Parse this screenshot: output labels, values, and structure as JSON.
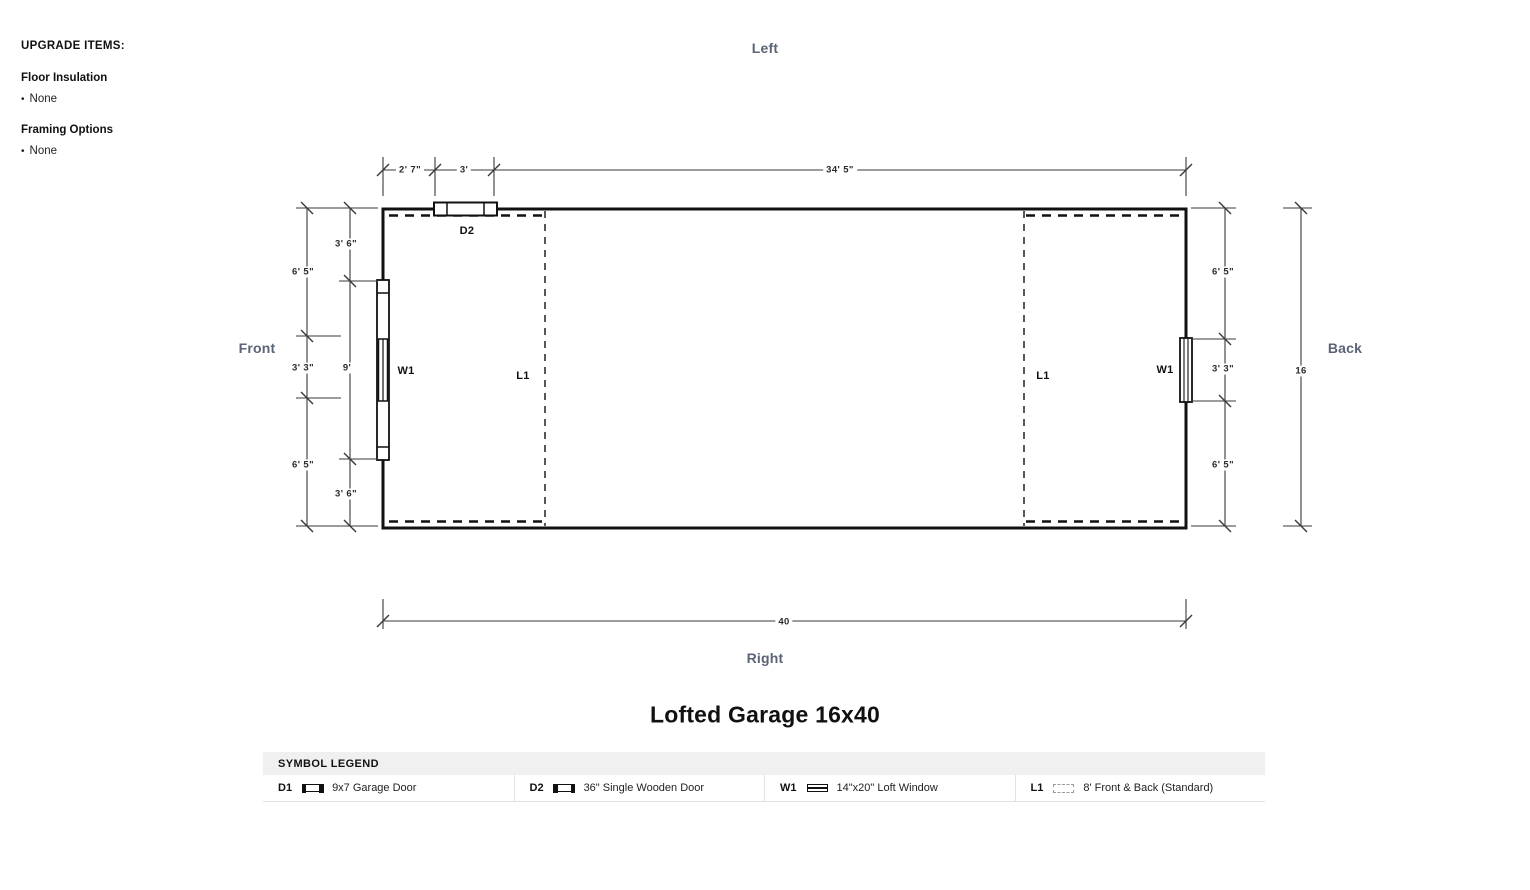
{
  "upgrade": {
    "title": "UPGRADE ITEMS:",
    "bullet": "•",
    "sections": [
      {
        "label": "Floor Insulation",
        "value": "None"
      },
      {
        "label": "Framing Options",
        "value": "None"
      }
    ]
  },
  "orientation": {
    "top": "Left",
    "bottom": "Right",
    "left": "Front",
    "right": "Back"
  },
  "plan": {
    "symbols": {
      "door_top": "D2",
      "window_front": "W1",
      "loft_front": "L1",
      "loft_back": "L1",
      "window_back": "W1"
    },
    "dims": {
      "top_offset": "2' 7\"",
      "top_door": "3'",
      "top_remainder": "34' 5\"",
      "left_outer_top": "6' 5\"",
      "left_outer_mid": "3' 3\"",
      "left_outer_bottom": "6' 5\"",
      "left_inner_top": "3' 6\"",
      "left_inner_mid": "9'",
      "left_inner_bottom": "3' 6\"",
      "right_top": "6' 5\"",
      "right_mid": "3' 3\"",
      "right_bottom": "6' 5\"",
      "overall_depth": "16",
      "overall_width": "40"
    }
  },
  "title": "Lofted Garage 16x40",
  "legend": {
    "header": "SYMBOL LEGEND",
    "items": [
      {
        "code": "D1",
        "desc": "9x7 Garage Door"
      },
      {
        "code": "D2",
        "desc": "36\" Single Wooden Door"
      },
      {
        "code": "W1",
        "desc": "14\"x20\" Loft Window"
      },
      {
        "code": "L1",
        "desc": "8' Front & Back (Standard)"
      }
    ]
  }
}
